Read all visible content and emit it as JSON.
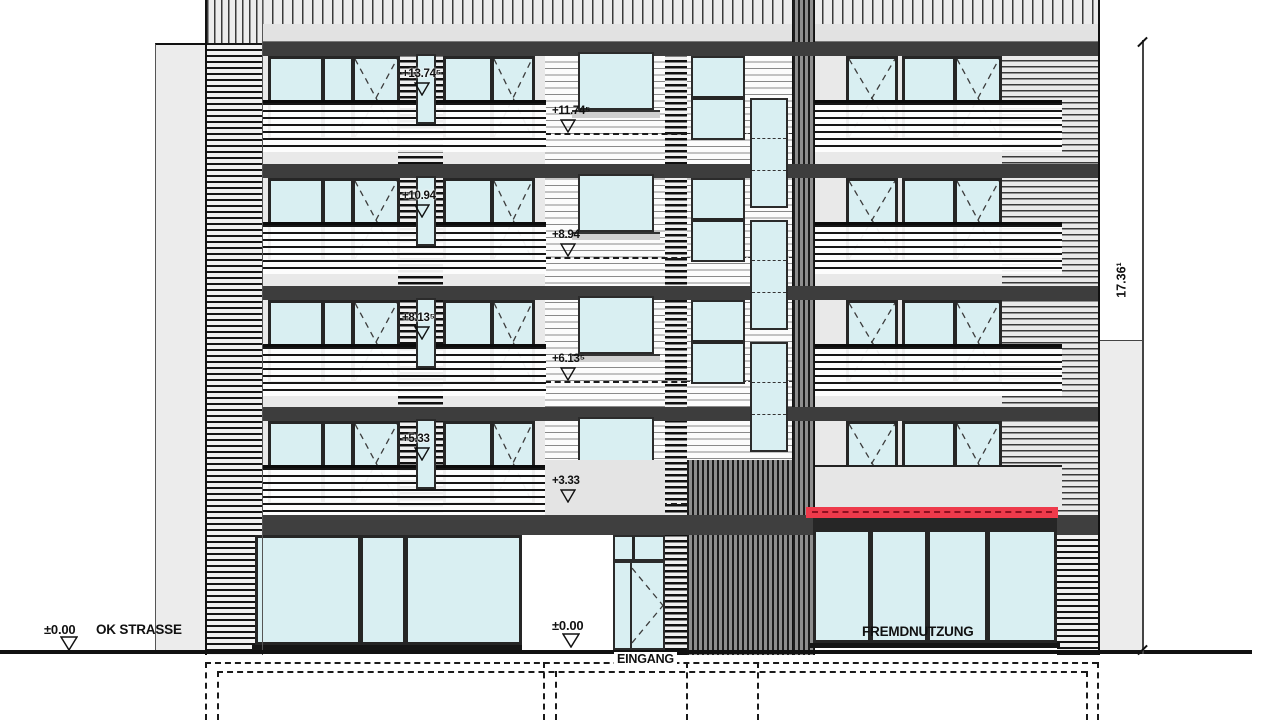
{
  "drawing": {
    "type": "building-elevation",
    "annotations": {
      "street_level": {
        "value": "±0.00",
        "label": "OK STRASSE"
      },
      "entrance_level": {
        "value": "±0.00"
      },
      "entrance_label": "EINGANG",
      "commercial_label": "FREMDNUTZUNG",
      "total_height": "17.36¹"
    },
    "floor_levels": [
      "+11.74⁵",
      "+8.94",
      "+6.13⁵",
      "+3.33"
    ],
    "lintel_levels": [
      "+13.74⁵",
      "+10.94",
      "+8.13⁵",
      "+5.33"
    ],
    "colors": {
      "glass": "#d9eff2",
      "awning_red": "#ee3a4b",
      "wall_gray": "#e9e9e9",
      "slab_dark": "#3d3d3d",
      "neighbor_gray": "#ececec"
    }
  }
}
